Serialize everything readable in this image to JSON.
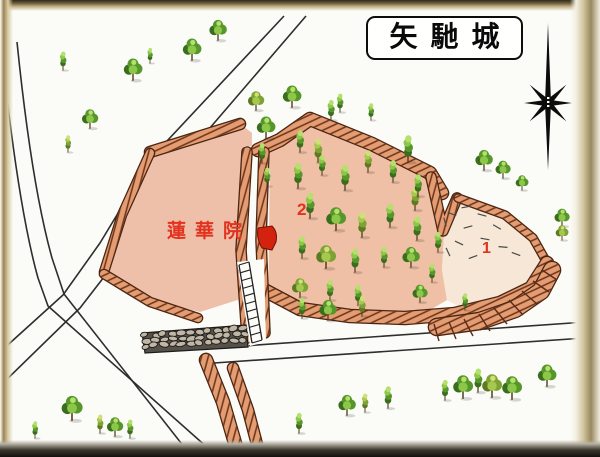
{
  "title_box": {
    "text": "矢馳城"
  },
  "labels": {
    "temple": "蓮華院",
    "enclosure_2": "2",
    "enclosure_1": "1"
  },
  "colors": {
    "label_red": "#e3321e",
    "terrain_pink": "#f0c0a6",
    "bank_salmon": "#e49d72",
    "bank_outline": "#4a2512",
    "enclosure1_cream": "#f6e7d6",
    "tree_green": "#57962a",
    "road_line": "#2e2e2e",
    "frame_tan": "#9c8454",
    "marker_red": "#d3230e"
  },
  "icons": {
    "compass": "compass-rose-icon",
    "stairs": "stairs-icon",
    "stone_wall": "stone-wall",
    "temple_marker": "temple-building-marker",
    "tree": "tree-icon"
  },
  "map": {
    "type": "hand-drawn-castle-map",
    "trees": [
      [
        63,
        70,
        0.55,
        "t"
      ],
      [
        90,
        128,
        0.7,
        "r"
      ],
      [
        68,
        152,
        0.5,
        "t"
      ],
      [
        133,
        80,
        0.8,
        "r"
      ],
      [
        150,
        63,
        0.45,
        "t"
      ],
      [
        192,
        60,
        0.8,
        "r"
      ],
      [
        218,
        40,
        0.75,
        "r"
      ],
      [
        256,
        110,
        0.7,
        "r"
      ],
      [
        292,
        107,
        0.8,
        "r"
      ],
      [
        340,
        112,
        0.55,
        "t"
      ],
      [
        371,
        120,
        0.5,
        "t"
      ],
      [
        408,
        162,
        0.8,
        "t"
      ],
      [
        415,
        210,
        0.7,
        "t"
      ],
      [
        484,
        170,
        0.75,
        "r"
      ],
      [
        503,
        178,
        0.65,
        "r"
      ],
      [
        522,
        190,
        0.55,
        "r"
      ],
      [
        562,
        226,
        0.65,
        "r"
      ],
      [
        562,
        240,
        0.55,
        "r"
      ],
      [
        266,
        138,
        0.8,
        "r"
      ],
      [
        262,
        163,
        0.6,
        "t"
      ],
      [
        267,
        186,
        0.55,
        "t"
      ],
      [
        300,
        152,
        0.65,
        "t"
      ],
      [
        318,
        162,
        0.7,
        "t"
      ],
      [
        331,
        120,
        0.6,
        "t"
      ],
      [
        298,
        188,
        0.75,
        "t"
      ],
      [
        322,
        175,
        0.6,
        "t"
      ],
      [
        345,
        190,
        0.75,
        "t"
      ],
      [
        368,
        172,
        0.65,
        "t"
      ],
      [
        393,
        182,
        0.65,
        "t"
      ],
      [
        418,
        196,
        0.65,
        "t"
      ],
      [
        310,
        218,
        0.75,
        "t"
      ],
      [
        336,
        230,
        0.85,
        "r"
      ],
      [
        362,
        237,
        0.75,
        "t"
      ],
      [
        390,
        227,
        0.7,
        "t"
      ],
      [
        417,
        240,
        0.7,
        "t"
      ],
      [
        438,
        252,
        0.6,
        "t"
      ],
      [
        302,
        258,
        0.65,
        "t"
      ],
      [
        326,
        268,
        0.85,
        "r"
      ],
      [
        355,
        272,
        0.7,
        "t"
      ],
      [
        384,
        267,
        0.6,
        "t"
      ],
      [
        411,
        267,
        0.75,
        "r"
      ],
      [
        432,
        282,
        0.55,
        "t"
      ],
      [
        300,
        297,
        0.7,
        "r"
      ],
      [
        330,
        300,
        0.6,
        "t"
      ],
      [
        358,
        305,
        0.6,
        "t"
      ],
      [
        302,
        318,
        0.6,
        "t"
      ],
      [
        328,
        320,
        0.75,
        "r"
      ],
      [
        362,
        316,
        0.6,
        "t"
      ],
      [
        420,
        302,
        0.65,
        "r"
      ],
      [
        465,
        310,
        0.5,
        "t"
      ],
      [
        35,
        438,
        0.5,
        "t"
      ],
      [
        72,
        420,
        0.9,
        "r"
      ],
      [
        100,
        433,
        0.55,
        "t"
      ],
      [
        115,
        436,
        0.7,
        "r"
      ],
      [
        130,
        438,
        0.55,
        "t"
      ],
      [
        299,
        433,
        0.6,
        "t"
      ],
      [
        347,
        415,
        0.75,
        "r"
      ],
      [
        365,
        412,
        0.55,
        "t"
      ],
      [
        388,
        408,
        0.65,
        "t"
      ],
      [
        445,
        400,
        0.6,
        "t"
      ],
      [
        463,
        398,
        0.85,
        "r"
      ],
      [
        478,
        392,
        0.7,
        "t"
      ],
      [
        492,
        397,
        0.85,
        "r"
      ],
      [
        512,
        399,
        0.85,
        "r"
      ],
      [
        547,
        386,
        0.8,
        "r"
      ]
    ]
  }
}
